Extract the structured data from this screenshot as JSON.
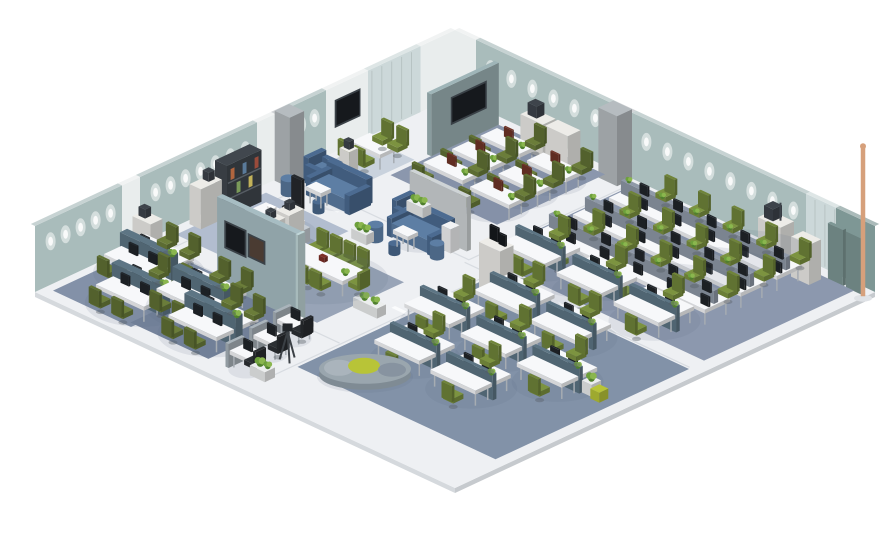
{
  "meta": {
    "description": "Isometric 3D rendering of an open-plan office floor layout with workstation clusters, meeting rooms, lounges and an executive office",
    "background": "#ffffff"
  },
  "palette": {
    "floor": "#eef0f3",
    "floorEdge": "#d5d9dd",
    "floorLine": "#dfe3e6",
    "seam": "#d8dce1",
    "wallTeal": "#a9bcbb",
    "wallTealDark": "#7e9795",
    "wallPanel": "#e9eded",
    "wallGlass": "#ccd8d9",
    "wallColumn": "#b6bcc0",
    "wallShade": "#90a3a2",
    "mullion": "#b7c3c3",
    "partition": "#a7bdc3",
    "partitionDesk": "#5d7584",
    "loungeWall": "#cfd4d6",
    "carpetTraining": "#8b97ad",
    "carpetOfficeR": "#8c98ae",
    "carpetNook": "#c9d2dd",
    "carpetExec": "#b2bdcf",
    "carpetConf": "#98a4b7",
    "carpetLeft": "#8391a8",
    "carpetBL": "#75839b",
    "carpetBR": "#8292a8",
    "deskTop": "#f7f8fa",
    "deskLeg": "#a6acb2",
    "spine": "#8f99a8",
    "chairGreen": "#7c9340",
    "chairOlive": "#6b7d3a",
    "chairBlack": "#2c3034",
    "chairGray": "#8d959d",
    "monitor": "#20252a",
    "monitorRust": "#703428",
    "screen": "#16191d",
    "screenFrame": "#3a4147",
    "screenBrown": "#4a3b32",
    "cabinet": "#edece8",
    "equip": "#3e444b",
    "shelfDark": "#41474e",
    "sofa": "#5d7ea4",
    "sofaDark": "#4c6b91",
    "plantDark": "#4f7f2e",
    "plant": "#6da03c",
    "plantLight": "#8ab64e",
    "pot": "#eceeee",
    "lime": "#b8c437",
    "benchGray": "#9aa6ae",
    "benchGrayDark": "#7f8b94",
    "execFront": "#5d7d9a",
    "execSide": "#c6cdd4",
    "pole": "#d6a07b",
    "red": "#7e2f26",
    "white": "#ffffff",
    "books": [
      "#9a4b3b",
      "#c2b25a",
      "#5a7a9a",
      "#7a9a5a",
      "#b0653f"
    ]
  },
  "walls": {
    "top_left": {
      "height": 66,
      "segments": [
        [
          0,
          1.15,
          "wallPanel"
        ],
        [
          1.15,
          2.9,
          "wallGlass"
        ],
        [
          2.9,
          4.3,
          "wallPanel"
        ],
        [
          4.3,
          5.55,
          "wallTeal"
        ],
        [
          5.55,
          6.0,
          "wallColumn"
        ],
        [
          6.0,
          6.6,
          "wallPanel"
        ],
        [
          6.6,
          10.5,
          "wallTeal"
        ],
        [
          10.5,
          11.1,
          "wallPanel"
        ],
        [
          11.1,
          14,
          "wallTeal"
        ]
      ],
      "lights": [
        4.7,
        5.15,
        7.0,
        7.5,
        8.0,
        8.5,
        9.0,
        9.5,
        10.0,
        11.5,
        12.0,
        12.5,
        13.0,
        13.5
      ],
      "tv": {
        "v1": 3.15,
        "v2": 3.95,
        "h1": 26,
        "h2": 50
      }
    },
    "top_right": {
      "height": 66,
      "segments": [
        [
          0,
          0.7,
          "wallPanel"
        ],
        [
          0.7,
          5.3,
          "wallTeal"
        ],
        [
          5.3,
          5.9,
          "wallColumn"
        ],
        [
          5.9,
          11.7,
          "wallTeal"
        ],
        [
          11.7,
          12.7,
          "wallGlass"
        ],
        [
          12.7,
          14,
          "wallTealDark"
        ]
      ],
      "lights": [
        1.2,
        1.9,
        2.6,
        3.3,
        4.0,
        4.7,
        6.4,
        7.1,
        7.8,
        8.5,
        9.2,
        9.9,
        10.6,
        11.3
      ]
    },
    "columns": [
      [
        5.3,
        0.02,
        0.62,
        0.5,
        70
      ],
      [
        0.02,
        5.55,
        0.5,
        0.48,
        70
      ]
    ],
    "boards": [
      [
        12.75,
        13.25
      ],
      [
        13.35,
        13.85
      ]
    ],
    "pole": {
      "u": 13.95,
      "v": 0.35,
      "h": 150
    }
  },
  "zones": {
    "training_room": {
      "carpet": [
        1.75,
        0.3,
        3.55,
        3.6
      ],
      "wall": {
        "u": 1.62,
        "v1": 0.3,
        "v2": 2.55,
        "h": 62
      },
      "tv": {
        "v1": 0.75,
        "v2": 1.85,
        "h1": 24,
        "h2": 48
      },
      "cabinets": [
        [
          2.95,
          0.35,
          0.75,
          0.42,
          34
        ],
        [
          3.78,
          0.35,
          0.75,
          0.42,
          34
        ]
      ],
      "printer": [
        3.08,
        0.4,
        0.3,
        0.26,
        12
      ],
      "desks": [
        [
          2.45,
          1.05
        ],
        [
          4.1,
          1.15
        ],
        [
          2.45,
          2.0
        ],
        [
          4.1,
          2.1
        ],
        [
          2.45,
          2.95
        ],
        [
          4.1,
          3.05
        ]
      ]
    },
    "open_office_right": {
      "carpet": [
        6.15,
        0.3,
        7.45,
        5.0
      ],
      "rows": [
        [
          6.8,
          5.6,
          1.25
        ],
        [
          6.8,
          5.6,
          2.45
        ],
        [
          6.8,
          5.6,
          3.65
        ]
      ],
      "side_desks": [
        [
          7.35,
          4.5
        ],
        [
          9.35,
          4.6
        ],
        [
          11.35,
          4.7
        ]
      ],
      "cabinets": [
        [
          10.95,
          0.4,
          0.75,
          0.45,
          44
        ],
        [
          12.05,
          0.45,
          0.6,
          0.4,
          40
        ]
      ]
    },
    "meeting_nook": {
      "rug": [
        0.25,
        2.95,
        1.35,
        1.75
      ],
      "table": [
        0.5,
        3.35,
        0.95,
        0.6
      ],
      "chairs": [
        [
          0.68,
          3.1,
          "-v"
        ],
        [
          1.18,
          3.1,
          "-v"
        ],
        [
          0.68,
          4.2,
          "+v"
        ],
        [
          1.18,
          4.2,
          "+v"
        ]
      ]
    },
    "lounge_wall": {
      "shelf": [
        1.0,
        4.55,
        0.32,
        0.3,
        30
      ],
      "armchair": [
        0.6,
        4.95
      ],
      "sofa": [
        1.15,
        5.35,
        1.25,
        0.62
      ],
      "tub": [
        0.7,
        6.25
      ],
      "pouf": [
        1.85,
        6.4
      ],
      "table": [
        1.35,
        5.98,
        0.5,
        0.34
      ]
    },
    "lounge_center": {
      "backwall": [
        3.85,
        5.22,
        1.9,
        0.14,
        54
      ],
      "sofa": [
        3.95,
        5.45,
        1.3,
        0.62
      ],
      "armchair": [
        3.6,
        5.0
      ],
      "tub": [
        3.8,
        6.45
      ],
      "tub2": [
        5.45,
        6.05
      ],
      "pouf": [
        4.6,
        6.62
      ],
      "table": [
        4.35,
        6.08,
        0.5,
        0.34
      ],
      "side": [
        5.25,
        5.4,
        0.3,
        0.3,
        24
      ]
    },
    "executive_office": {
      "rug": [
        0.3,
        6.6,
        2.75,
        3.0
      ],
      "bookshelf": [
        0.15,
        7.0,
        0.4,
        1.15,
        52
      ],
      "cabinet": [
        0.15,
        8.3,
        0.38,
        0.7,
        40
      ],
      "desk_top": [
        1.25,
        7.55,
        1.3,
        0.6
      ],
      "desk_side": [
        2.35,
        7.6,
        0.42,
        0.8,
        14
      ],
      "chair": [
        1.75,
        7.18
      ]
    },
    "conference_area": {
      "rug": [
        2.5,
        7.5,
        3.3,
        2.9
      ],
      "cabinets": [
        [
          2.6,
          8.05,
          0.42,
          0.5,
          42
        ],
        [
          2.6,
          8.68,
          0.42,
          0.5,
          42
        ]
      ],
      "table": [
        3.25,
        8.35,
        2.1,
        0.75
      ],
      "red_item": [
        4.2,
        8.62
      ],
      "chairs_top": [
        3.5,
        3.95,
        4.4,
        4.85
      ],
      "top_v": 8.08,
      "chairs_bottom": [
        3.5,
        3.95,
        4.4,
        4.85
      ],
      "bottom_v": 9.32,
      "end_chairs": [
        [
          3.02,
          8.7,
          "-u"
        ],
        [
          5.48,
          8.7,
          "+u"
        ]
      ]
    },
    "open_office_left": {
      "rug": [
        0.25,
        10.35,
        2.6,
        3.3
      ],
      "cabinet": [
        0.2,
        10.55,
        0.6,
        0.4,
        36
      ],
      "clusters": [
        [
          1.2,
          11.4
        ],
        [
          2.15,
          12.62
        ]
      ]
    },
    "open_office_bottom_left": {
      "rug": [
        2.68,
        10.6,
        2.6,
        2.9
      ],
      "wall": {
        "u1": 2.7,
        "u2": 5.35,
        "v": 10.45,
        "h": 86
      },
      "screens": [
        [
          3.0,
          3.62,
          40,
          64,
          "screen"
        ],
        [
          3.78,
          4.25,
          42,
          62,
          "screenBrown"
        ]
      ],
      "clusters": [
        [
          3.3,
          11.75
        ],
        [
          4.45,
          12.5
        ]
      ]
    },
    "corridor": {
      "desks": [
        [
          5.62,
          11.05
        ],
        [
          5.78,
          12.0
        ],
        [
          5.94,
          12.95
        ]
      ],
      "tripod": [
        6.62,
        12.2
      ],
      "planter": [
        6.55,
        13.05
      ]
    },
    "open_office_bottom_right": {
      "rug": [
        7.05,
        5.85,
        6.6,
        6.45
      ],
      "av_cabinet": [
        7.25,
        6.0,
        0.7,
        0.45,
        46
      ],
      "clusters": [
        [
          8.6,
          6.6
        ],
        [
          10.6,
          6.72
        ],
        [
          7.92,
          8.25
        ],
        [
          9.92,
          8.37
        ],
        [
          11.92,
          8.5
        ],
        [
          8.72,
          10.05
        ],
        [
          10.72,
          10.18
        ]
      ],
      "bench": [
        8.35,
        11.35
      ],
      "planter_cubes": [
        12.7,
        8.15
      ]
    }
  },
  "planters": [
    [
      3.28,
      4.62,
      0.55,
      0.28
    ],
    [
      5.85,
      8.95,
      0.8,
      0.3
    ],
    [
      3.35,
      6.55,
      0.5,
      0.26
    ]
  ],
  "seams": [
    {
      "t": "v",
      "u": 0.72,
      "a": 4.35,
      "b": 13.55
    },
    {
      "t": "u",
      "v": 5.62,
      "a": 0.75,
      "b": 6.1
    },
    {
      "t": "v",
      "u": 6.08,
      "a": 0.35,
      "b": 5.6
    },
    {
      "t": "u",
      "v": 5.78,
      "a": 6.1,
      "b": 13.6
    },
    {
      "t": "v",
      "u": 6.95,
      "a": 5.8,
      "b": 13.2
    },
    {
      "t": "u",
      "v": 10.32,
      "a": 0.3,
      "b": 2.68
    },
    {
      "t": "v",
      "u": 2.62,
      "a": 10.3,
      "b": 13.7
    },
    {
      "t": "u",
      "v": 7.35,
      "a": 0.72,
      "b": 2.55
    },
    {
      "t": "u",
      "v": 10.75,
      "a": 5.4,
      "b": 6.9
    }
  ],
  "bars": [
    [
      1.7,
      6.0
    ],
    [
      2.2,
      9.9
    ],
    [
      6.35,
      2.9
    ],
    [
      6.5,
      8.5
    ],
    [
      10.4,
      5.68
    ],
    [
      3.4,
      5.15
    ]
  ]
}
